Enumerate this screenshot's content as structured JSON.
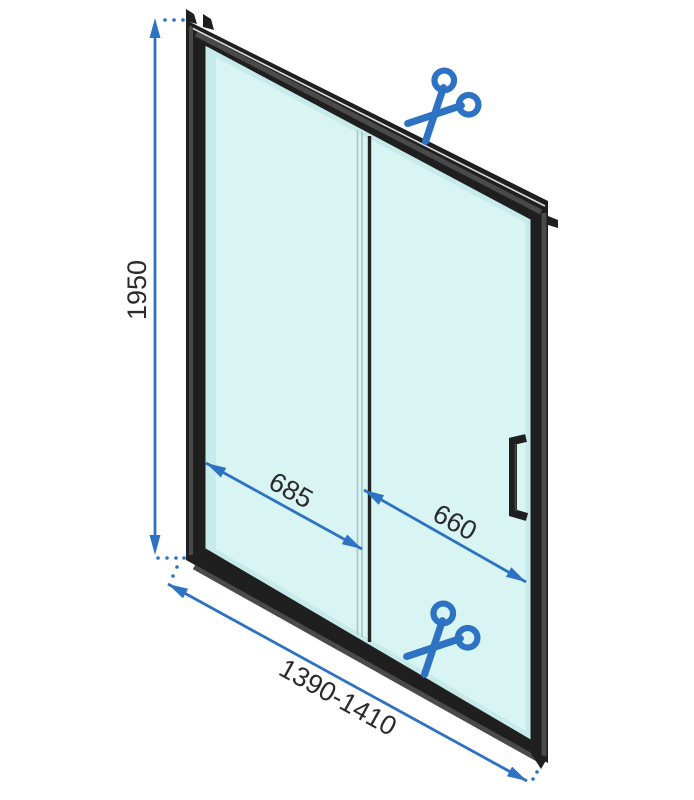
{
  "diagram": {
    "type": "sliding-shower-door-dimension-drawing",
    "dimensions": {
      "height": "1950",
      "door_panel_width": "685",
      "fixed_panel_width": "660",
      "total_width_range": "1390-1410"
    },
    "icons": {
      "top": "scissors-icon",
      "bottom": "scissors-icon"
    },
    "colors": {
      "accent": "#2E72C4",
      "frame": "#1F1F1F",
      "frameFacet": "#4A4A4A",
      "frameLight": "#DCDCDC",
      "glass": "#D8F4F3",
      "glassEdge": "#C6EBEA",
      "dividerLight": "#A9C6C6",
      "dividerDark": "#242424",
      "label": "#2B2B2B",
      "background": "#FFFFFF"
    }
  }
}
